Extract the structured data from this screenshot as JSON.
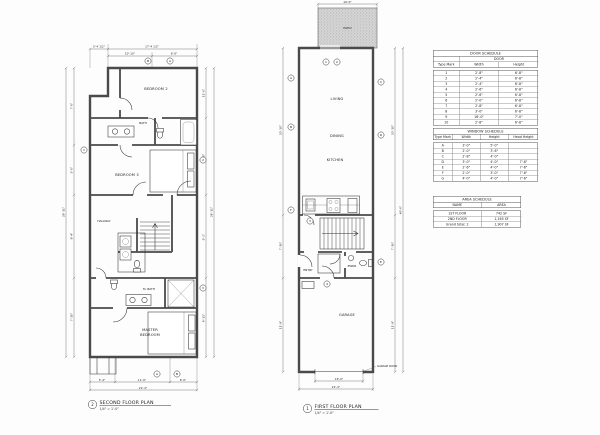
{
  "sheet": {
    "background": "#fdfdfd",
    "line_color": "#1c1c1c",
    "wall_color": "#4a4a4a"
  },
  "plans": {
    "second": {
      "caption": {
        "number": "2",
        "title": "SECOND FLOOR PLAN",
        "scale": "1/4\" = 1'-0\""
      },
      "rooms": {
        "bedroom2": "BEDROOM 2",
        "bath": "BATH",
        "bedroom3": "BEDROOM 3",
        "hallway": "HALLWAY",
        "mbath": "M. BATH",
        "master_line1": "MASTER",
        "master_line2": "BEDROOM"
      },
      "dims": {
        "top_left": "5'-4 1/2\"",
        "top_right": "17'-4 1/2\"",
        "top_seg1": "10'-10\"",
        "top_seg2": "6'-6\"",
        "left1": "7'-6\"",
        "left2": "5'-0\"",
        "left3": "8'-4\"",
        "left4": "7'-10\"",
        "left_overall": "28'-11\"",
        "right1": "11'-0\"",
        "right2": "8'-0\"",
        "right3": "6'-2\"",
        "right4": "4'-11\"",
        "right_overall": "28'-11\"",
        "bottom1": "5'-4\"",
        "bottom2": "11'-0\"",
        "bottom3": "6'-0\"",
        "bottom_overall": "22'-4\""
      },
      "tags": {
        "t1": "B",
        "t2": "A",
        "t3": "1",
        "t4": "2",
        "t5": "3",
        "t6": "A",
        "t7": "B"
      }
    },
    "first": {
      "caption": {
        "number": "1",
        "title": "FIRST FLOOR PLAN",
        "scale": "1/4\" = 1'-0\""
      },
      "rooms": {
        "patio": "PATIO",
        "living": "LIVING",
        "dining": "DINING",
        "kitchen": "KITCHEN",
        "entry": "ENTRY",
        "pwdr": "PWDR",
        "garage": "GARAGE"
      },
      "annotations": {
        "garage_door": "GARAGE DOOR"
      },
      "dims": {
        "patio_width": "16'-0\"",
        "left1": "20'-10\"",
        "left2": "7'-10\"",
        "left3": "11'-9\"",
        "right1": "20'-10\"",
        "right2": "7'-10\"",
        "right3": "11'-9\"",
        "right_overall": "40'-6\"",
        "bottom_opening": "16'-0\"",
        "bottom_overall": "22'-4\""
      },
      "tags": {
        "a": "A",
        "b": "B",
        "c": "C",
        "d": "D",
        "e": "E",
        "f": "F",
        "n1": "1",
        "n2": "2",
        "n3": "3",
        "n4": "4"
      }
    }
  },
  "schedules": {
    "door": {
      "title": "DOOR SCHEDULE",
      "group_header": "DOOR",
      "columns": [
        "Type Mark",
        "Width",
        "Height"
      ],
      "rows": [
        [
          "1",
          "2'-8\"",
          "6'-8\""
        ],
        [
          "2",
          "2'-4\"",
          "6'-8\""
        ],
        [
          "3",
          "2'-4\"",
          "6'-8\""
        ],
        [
          "4",
          "2'-6\"",
          "6'-8\""
        ],
        [
          "5",
          "2'-6\"",
          "6'-8\""
        ],
        [
          "6",
          "2'-0\"",
          "6'-8\""
        ],
        [
          "7",
          "2'-8\"",
          "6'-8\""
        ],
        [
          "8",
          "3'-0\"",
          "6'-8\""
        ],
        [
          "9",
          "16'-0\"",
          "7'-0\""
        ],
        [
          "10",
          "2'-8\"",
          "6'-8\""
        ]
      ]
    },
    "window": {
      "title": "WINDOW SCHEDULE",
      "columns": [
        "Type Mark",
        "Width",
        "Height",
        "Head Height"
      ],
      "rows": [
        [
          "A",
          "3'-0\"",
          "5'-0\"",
          ""
        ],
        [
          "B",
          "2'-0\"",
          "3'-6\"",
          ""
        ],
        [
          "C",
          "2'-8\"",
          "4'-0\"",
          ""
        ],
        [
          "D",
          "3'-0\"",
          "4'-0\"",
          "7'-6\""
        ],
        [
          "E",
          "2'-6\"",
          "4'-0\"",
          "7'-6\""
        ],
        [
          "F",
          "2'-0\"",
          "3'-0\"",
          "7'-6\""
        ],
        [
          "G",
          "4'-0\"",
          "4'-0\"",
          "7'-6\""
        ]
      ]
    },
    "area": {
      "title": "AREA SCHEDULE",
      "columns": [
        "NAME",
        "AREA"
      ],
      "rows": [
        [
          "1ST FLOOR",
          "742 SF"
        ],
        [
          "2ND FLOOR",
          "1,165 SF"
        ],
        [
          "Grand total: 2",
          "1,907 SF"
        ]
      ]
    }
  }
}
